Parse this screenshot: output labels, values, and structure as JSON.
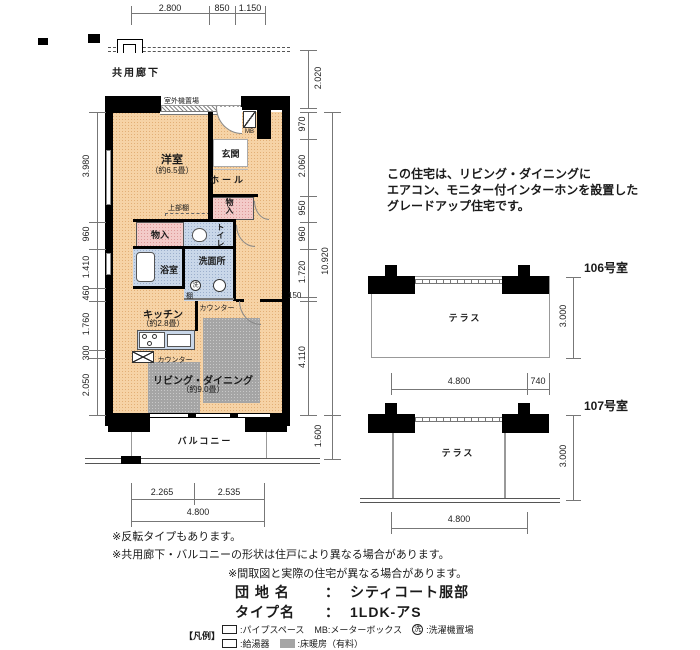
{
  "dimensions": {
    "top": [
      "2.800",
      "850",
      "1.150"
    ],
    "top_right": "2.020",
    "left": [
      "3.980",
      "960",
      "1.410",
      "460",
      "1.760",
      "300",
      "2.050"
    ],
    "right": [
      "970",
      "2.060",
      "950",
      "960",
      "1.720",
      "150",
      "4.110"
    ],
    "right_total": "10.920",
    "right_bottom": "1.600",
    "bottom": [
      "2.265",
      "2.535"
    ],
    "bottom_total": "4.800"
  },
  "corridor": {
    "label": "共用廊下",
    "outdoor_unit": "室外機置場"
  },
  "rooms": {
    "bedroom": "洋室",
    "bedroom_size": "（約6.5畳）",
    "entrance": "玄関",
    "hall": "ホール",
    "mb": "MB",
    "upper_shelf": "上部棚",
    "closet_hall": "物入",
    "closet_left": "物入",
    "toilet": "トイレ",
    "bath": "浴室",
    "washroom": "洗面所",
    "laundry_mark": "洗",
    "shelf": "棚",
    "counter_top": "カウンター",
    "counter_kitchen": "カウンター",
    "kitchen": "キッチン",
    "kitchen_size": "（約2.8畳）",
    "living": "リビング・ダイニング",
    "living_size": "（約9.0畳）",
    "balcony": "バルコニー"
  },
  "description": [
    "この住宅は、リビング・ダイニングに",
    "エアコン、モニター付インターホンを設置した",
    "グレードアップ住宅です。"
  ],
  "terraces": [
    {
      "room": "106号室",
      "label": "テラス",
      "height": "3.000",
      "width": "4.800",
      "offset": "740"
    },
    {
      "room": "107号室",
      "label": "テラス",
      "height": "3.000",
      "width": "4.800"
    }
  ],
  "notes": [
    "※反転タイプもあります。",
    "※共用廊下・バルコニーの形状は住戸により異なる場合があります。",
    "※間取図と実際の住宅が異なる場合があります。"
  ],
  "estate": {
    "name_label": "団 地 名",
    "separator": "：",
    "name": "シティコート服部",
    "type_label": "タイプ名",
    "type_value": "1LDK-アS"
  },
  "legend": {
    "title": "【凡例】",
    "pipe_space": ":パイプスペース",
    "mb": "MB:メーターボックス",
    "laundry_mark": "洗",
    "laundry": ":洗濯機置場",
    "water_heater": ":給湯器",
    "floor_heating": ":床暖房（有料）"
  },
  "colors": {
    "wall": "#000000",
    "room_warm": "#f6d3a6",
    "room_pink": "#f3cbc9",
    "room_blue": "#c9d7e9",
    "floor_heating": "#a5a5a5"
  }
}
